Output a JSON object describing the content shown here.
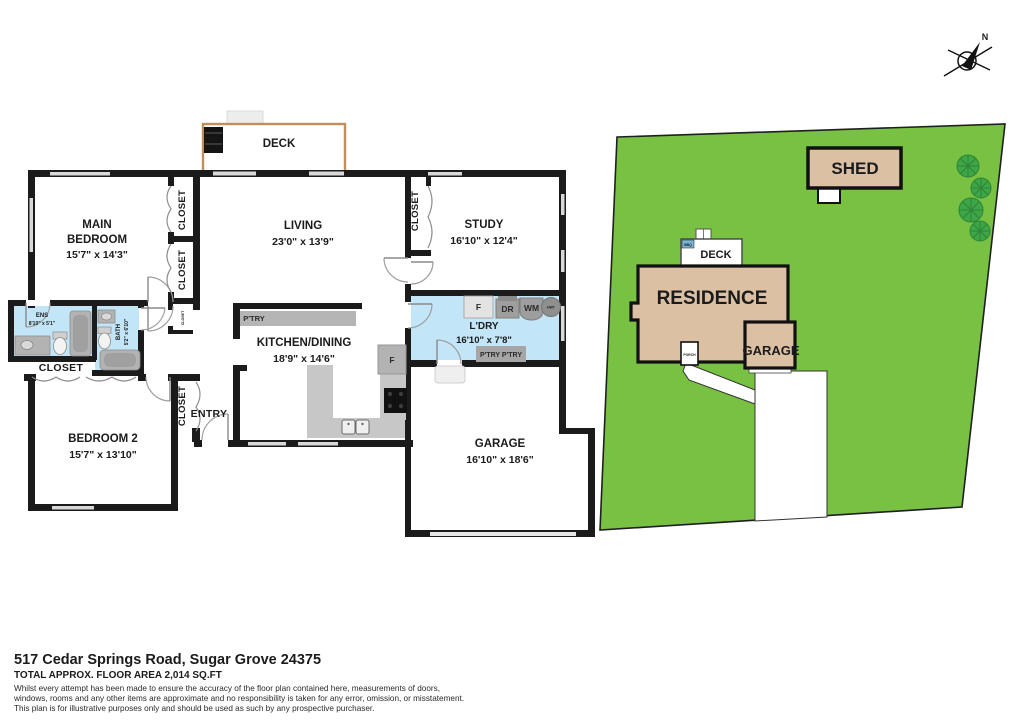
{
  "colors": {
    "lawn": "#79C143",
    "tree": "#3DA647",
    "building_tan": "#DCC0A4",
    "wet_room_blue": "#C2E5F7",
    "wall_black": "#1B1B1B",
    "deck_border_brown": "#C0905C",
    "fixture_gray": "#B3B3B3"
  },
  "compass": {
    "north_label": "N"
  },
  "floor_plan": {
    "deck": {
      "label": "DECK",
      "bbq_label": "B.B.Q"
    },
    "main_bedroom": {
      "name_line1": "MAIN",
      "name_line2": "BEDROOM",
      "dims": "15'7\" x 14'3\""
    },
    "living": {
      "name": "LIVING",
      "dims": "23'0\" x 13'9\""
    },
    "study": {
      "name": "STUDY",
      "dims": "16'10\" x 12'4\""
    },
    "kitchen": {
      "name": "KITCHEN/DINING",
      "dims": "18'9\" x 14'6\"",
      "pantry_label": "P'TRY",
      "fridge_label": "F"
    },
    "laundry": {
      "name": "L'DRY",
      "dims": "16'10\" x 7'8\"",
      "fridge_label": "F",
      "dryer_label": "DR",
      "washer_label": "WM",
      "hot_water_label": "HWT",
      "pantry_label": "P'TRY P'TRY"
    },
    "bedroom2": {
      "name": "BEDROOM 2",
      "dims": "15'7\" x 13'10\""
    },
    "garage": {
      "name": "GARAGE",
      "dims": "16'10\" x 18'6\""
    },
    "ensuite": {
      "name": "ENS",
      "dims": "8'10\" x 5'1\""
    },
    "bath": {
      "name": "BATH",
      "dims": "5'2\" x 6'10\""
    },
    "entry": {
      "label": "ENTRY"
    },
    "closets": {
      "main1": "CLOSET",
      "main2": "CLOSET",
      "hall_small": "CLOSET",
      "study": "CLOSET",
      "ens": "CLOSET",
      "entry": "CLOSET"
    }
  },
  "site_plan": {
    "residence_label": "RESIDENCE",
    "deck_label": "DECK",
    "garage_label": "GARAGE",
    "porch_label": "PORCH",
    "shed_label": "SHED",
    "bbq_label": "BBQ"
  },
  "footer": {
    "address": "517 Cedar Springs Road, Sugar Grove 24375",
    "area": "TOTAL APPROX. FLOOR AREA 2,014 SQ.FT",
    "disclaimer_line1": "Whilst every attempt has been made to ensure the accuracy of the floor plan contained here, measurements of doors,",
    "disclaimer_line2": "windows, rooms and any other items are approximate and no responsibility is taken for any error, omission, or misstatement.",
    "disclaimer_line3": "This plan is for illustrative purposes only and should be used as such by any prospective purchaser."
  }
}
